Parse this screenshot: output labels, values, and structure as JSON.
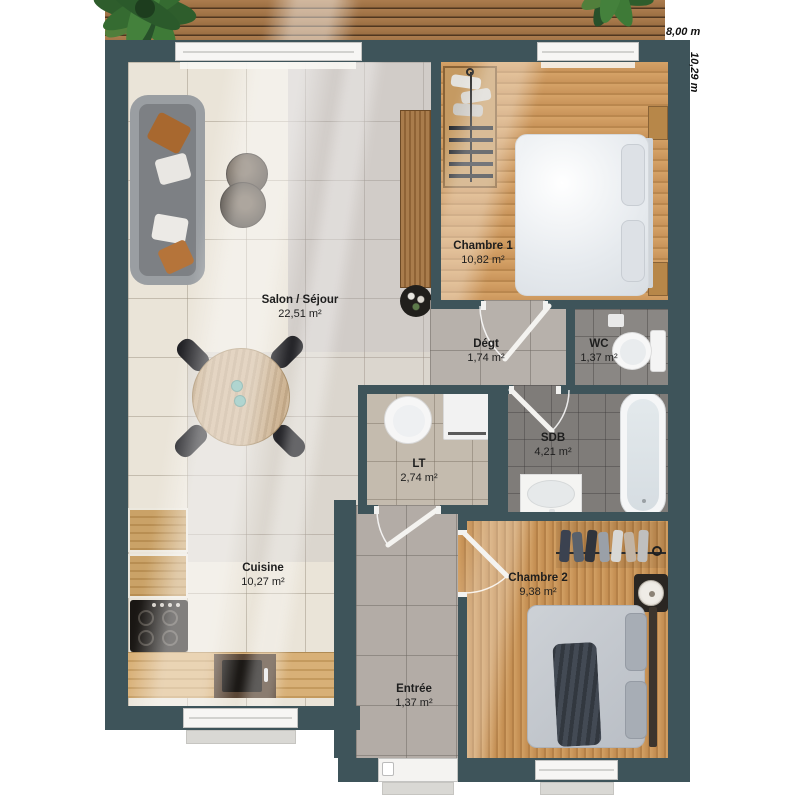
{
  "plan": {
    "exterior_dimensions": {
      "width": "8,00 m",
      "height": "10,29 m"
    },
    "rooms": [
      {
        "name": "Salon / Séjour",
        "area": "22,51 m²"
      },
      {
        "name": "Chambre 1",
        "area": "10,82 m²"
      },
      {
        "name": "Dégt",
        "area": "1,74 m²"
      },
      {
        "name": "WC",
        "area": "1,37 m²"
      },
      {
        "name": "SDB",
        "area": "4,21 m²"
      },
      {
        "name": "LT",
        "area": "2,74 m²"
      },
      {
        "name": "Cuisine",
        "area": "10,27 m²"
      },
      {
        "name": "Chambre 2",
        "area": "9,38 m²"
      },
      {
        "name": "Entrée",
        "area": "1,37 m²"
      }
    ],
    "colors": {
      "wall": "#3e545a",
      "wood_floor": "#cf9a5f",
      "tile_floor": "#eae4d8",
      "corridor_tile": "#b7b1ab",
      "wet_room_tile": "#85827f",
      "deck_wood": "#a87a4c"
    }
  }
}
